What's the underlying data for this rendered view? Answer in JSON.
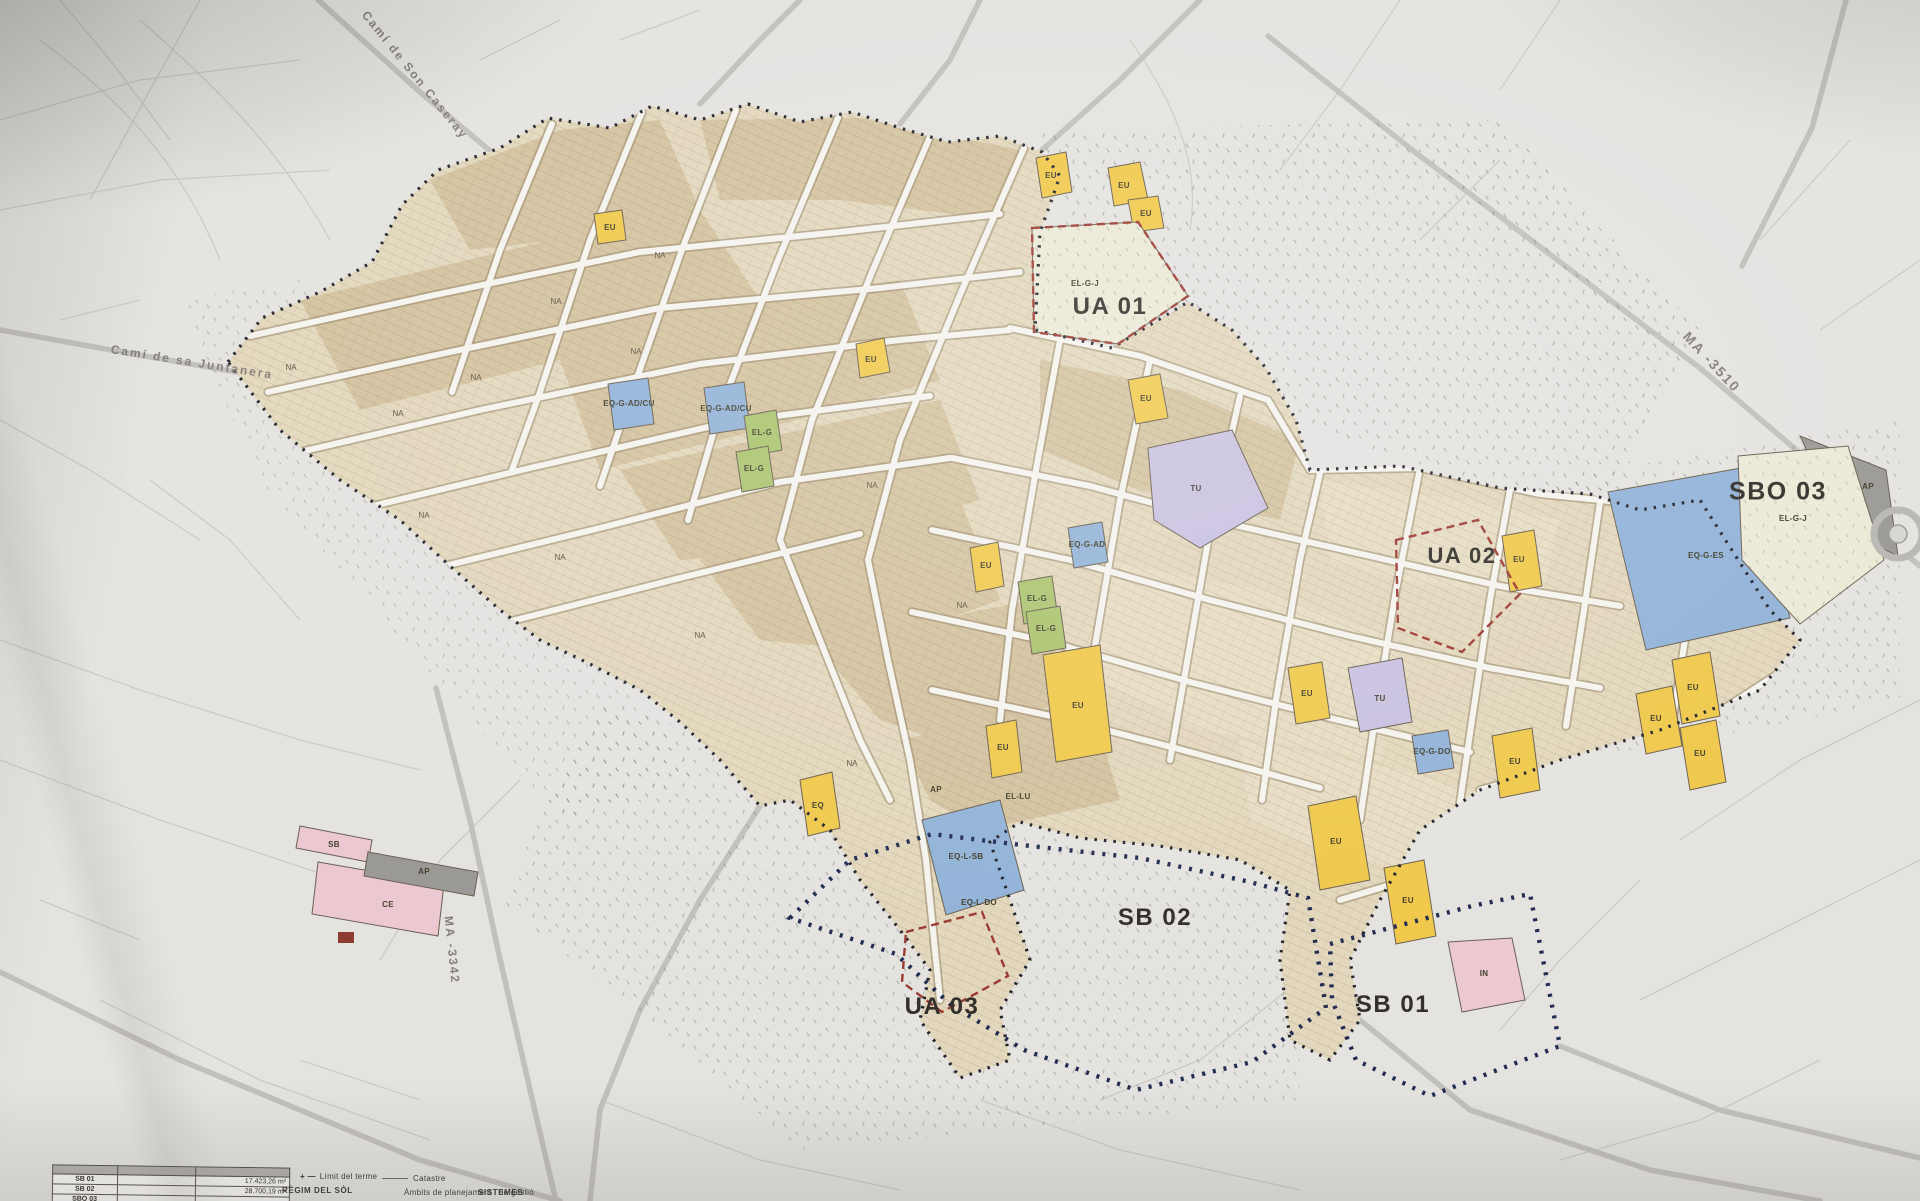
{
  "document_type": "Fotografia d'un plànol urbanístic de zonificació",
  "colors": {
    "paper": "#e4e3e0",
    "town_base": "#e3d8bd",
    "block_dark": "#cdb891",
    "street": "#f5f3ee",
    "yellow_eu": "#f0c94c",
    "blue_eq": "#92b3d8",
    "green_el": "#abc46f",
    "purple_tu": "#c9c1e0",
    "pink_zone": "#ecc8d0",
    "gray_ap": "#9b9995",
    "cream_elgj": "#ebe9d6",
    "red_dash": "#9c3b33",
    "navy_dots": "#232c52",
    "black_dots": "#23252e"
  },
  "map": {
    "labels": [
      {
        "id": "zone-label-ua-01",
        "cls": "zone",
        "text": "UA 01",
        "x": 1110,
        "y": 307,
        "fs": 24
      },
      {
        "id": "zone-label-ua-02",
        "cls": "zone",
        "text": "UA 02",
        "x": 1462,
        "y": 556,
        "fs": 22
      },
      {
        "id": "zone-label-ua-03",
        "cls": "zone",
        "text": "UA 03",
        "x": 942,
        "y": 1007,
        "fs": 24
      },
      {
        "id": "zone-label-sb-01",
        "cls": "zone",
        "text": "SB 01",
        "x": 1393,
        "y": 1005,
        "fs": 24
      },
      {
        "id": "zone-label-sb-02",
        "cls": "zone",
        "text": "SB 02",
        "x": 1155,
        "y": 918,
        "fs": 24
      },
      {
        "id": "zone-label-sbo-03",
        "cls": "zone",
        "text": "SBO 03",
        "x": 1778,
        "y": 492,
        "fs": 25
      },
      {
        "id": "road-label-cami-son-caseray",
        "cls": "road",
        "text": "Camí de Son Caseray",
        "x": 415,
        "y": 75,
        "rot": 51,
        "fs": 12
      },
      {
        "id": "road-label-cami-sa-juntanera",
        "cls": "road",
        "text": "Camí de sa Juntanera",
        "x": 192,
        "y": 362,
        "rot": 9,
        "fs": 12
      },
      {
        "id": "road-label-ma-3510",
        "cls": "road",
        "text": "MA -3510",
        "x": 1712,
        "y": 362,
        "rot": 47,
        "fs": 14
      },
      {
        "id": "road-label-ma-3342",
        "cls": "road",
        "text": "MA -3342",
        "x": 452,
        "y": 950,
        "rot": 84,
        "fs": 12
      },
      {
        "id": "parcel-label-eu",
        "cls": "parcel",
        "text": "EU",
        "x": 610,
        "y": 228
      },
      {
        "id": "parcel-label-eu",
        "cls": "parcel",
        "text": "EU",
        "x": 1051,
        "y": 176
      },
      {
        "id": "parcel-label-eu",
        "cls": "parcel",
        "text": "EU",
        "x": 1124,
        "y": 186
      },
      {
        "id": "parcel-label-eu",
        "cls": "parcel",
        "text": "EU",
        "x": 1146,
        "y": 214
      },
      {
        "id": "parcel-label-eu",
        "cls": "parcel",
        "text": "EU",
        "x": 871,
        "y": 360
      },
      {
        "id": "parcel-label-eu",
        "cls": "parcel",
        "text": "EU",
        "x": 1146,
        "y": 399
      },
      {
        "id": "parcel-label-eu",
        "cls": "parcel",
        "text": "EU",
        "x": 986,
        "y": 566
      },
      {
        "id": "parcel-label-eu",
        "cls": "parcel",
        "text": "EU",
        "x": 1003,
        "y": 748
      },
      {
        "id": "parcel-label-eq",
        "cls": "parcel",
        "text": "EQ",
        "x": 818,
        "y": 806
      },
      {
        "id": "parcel-label-eu",
        "cls": "parcel",
        "text": "EU",
        "x": 1307,
        "y": 694
      },
      {
        "id": "parcel-label-eu",
        "cls": "parcel",
        "text": "EU",
        "x": 1519,
        "y": 560
      },
      {
        "id": "parcel-label-eu",
        "cls": "parcel",
        "text": "EU",
        "x": 1693,
        "y": 688
      },
      {
        "id": "parcel-label-eu",
        "cls": "parcel",
        "text": "EU",
        "x": 1656,
        "y": 719
      },
      {
        "id": "parcel-label-eu",
        "cls": "parcel",
        "text": "EU",
        "x": 1700,
        "y": 754
      },
      {
        "id": "parcel-label-eu",
        "cls": "parcel",
        "text": "EU",
        "x": 1336,
        "y": 842
      },
      {
        "id": "parcel-label-eu",
        "cls": "parcel",
        "text": "EU",
        "x": 1408,
        "y": 901
      },
      {
        "id": "parcel-label-eu",
        "cls": "parcel",
        "text": "EU",
        "x": 1515,
        "y": 762
      },
      {
        "id": "parcel-label-eu",
        "cls": "parcel",
        "text": "EU",
        "x": 1078,
        "y": 706
      },
      {
        "id": "parcel-label-eq-g-adcu",
        "cls": "parcel",
        "text": "EQ-G-AD/CU",
        "x": 629,
        "y": 404
      },
      {
        "id": "parcel-label-eq-g-adcu",
        "cls": "parcel",
        "text": "EQ-G-AD/CU",
        "x": 726,
        "y": 409
      },
      {
        "id": "parcel-label-eq-g-ad",
        "cls": "parcel",
        "text": "EQ-G-AD",
        "x": 1087,
        "y": 545
      },
      {
        "id": "parcel-label-eq-g-es",
        "cls": "parcel",
        "text": "EQ-G-ES",
        "x": 1706,
        "y": 556
      },
      {
        "id": "parcel-label-eq-g-do",
        "cls": "parcel",
        "text": "EQ-G-DO",
        "x": 1432,
        "y": 752
      },
      {
        "id": "parcel-label-eq-l-sb",
        "cls": "parcel",
        "text": "EQ-L-SB",
        "x": 966,
        "y": 857
      },
      {
        "id": "parcel-label-eq-l-do",
        "cls": "parcel",
        "text": "EQ-L-DO",
        "x": 979,
        "y": 903
      },
      {
        "id": "parcel-label-el-lu",
        "cls": "parcel",
        "text": "EL-LU",
        "x": 1018,
        "y": 797
      },
      {
        "id": "parcel-label-ap",
        "cls": "parcel",
        "text": "AP",
        "x": 936,
        "y": 790
      },
      {
        "id": "parcel-label-el-g",
        "cls": "parcel",
        "text": "EL-G",
        "x": 762,
        "y": 433
      },
      {
        "id": "parcel-label-el-g",
        "cls": "parcel",
        "text": "EL-G",
        "x": 754,
        "y": 469
      },
      {
        "id": "parcel-label-el-g",
        "cls": "parcel",
        "text": "EL-G",
        "x": 1037,
        "y": 599
      },
      {
        "id": "parcel-label-el-g",
        "cls": "parcel",
        "text": "EL-G",
        "x": 1046,
        "y": 629
      },
      {
        "id": "parcel-label-tu",
        "cls": "parcel",
        "text": "TU",
        "x": 1196,
        "y": 489
      },
      {
        "id": "parcel-label-tu",
        "cls": "parcel",
        "text": "TU",
        "x": 1380,
        "y": 699
      },
      {
        "id": "parcel-label-el-g-j",
        "cls": "parcel",
        "text": "EL-G-J",
        "x": 1085,
        "y": 284
      },
      {
        "id": "parcel-label-el-g-j",
        "cls": "parcel",
        "text": "EL-G-J",
        "x": 1793,
        "y": 519
      },
      {
        "id": "parcel-label-ap",
        "cls": "parcel",
        "text": "AP",
        "x": 1868,
        "y": 487
      },
      {
        "id": "parcel-label-ap",
        "cls": "parcel",
        "text": "AP",
        "x": 424,
        "y": 872
      },
      {
        "id": "parcel-label-sb",
        "cls": "parcel",
        "text": "SB",
        "x": 334,
        "y": 845
      },
      {
        "id": "parcel-label-ce",
        "cls": "parcel",
        "text": "CE",
        "x": 388,
        "y": 905
      },
      {
        "id": "parcel-label-in",
        "cls": "parcel",
        "text": "IN",
        "x": 1484,
        "y": 974
      },
      {
        "id": "parcel-label-na",
        "cls": "na",
        "text": "NA",
        "x": 291,
        "y": 368
      },
      {
        "id": "parcel-label-na",
        "cls": "na",
        "text": "NA",
        "x": 398,
        "y": 414
      },
      {
        "id": "parcel-label-na",
        "cls": "na",
        "text": "NA",
        "x": 476,
        "y": 378
      },
      {
        "id": "parcel-label-na",
        "cls": "na",
        "text": "NA",
        "x": 556,
        "y": 302
      },
      {
        "id": "parcel-label-na",
        "cls": "na",
        "text": "NA",
        "x": 660,
        "y": 256
      },
      {
        "id": "parcel-label-na",
        "cls": "na",
        "text": "NA",
        "x": 424,
        "y": 516
      },
      {
        "id": "parcel-label-na",
        "cls": "na",
        "text": "NA",
        "x": 560,
        "y": 558
      },
      {
        "id": "parcel-label-na",
        "cls": "na",
        "text": "NA",
        "x": 700,
        "y": 636
      },
      {
        "id": "parcel-label-na",
        "cls": "na",
        "text": "NA",
        "x": 852,
        "y": 764
      },
      {
        "id": "parcel-label-na",
        "cls": "na",
        "text": "NA",
        "x": 636,
        "y": 352
      },
      {
        "id": "parcel-label-na",
        "cls": "na",
        "text": "NA",
        "x": 962,
        "y": 606
      },
      {
        "id": "parcel-label-na",
        "cls": "na",
        "text": "NA",
        "x": 872,
        "y": 486
      }
    ]
  },
  "legend": {
    "limit_symbol": "+ —",
    "limit_label": "Límit del terme",
    "catastre_label": "Catastre",
    "regim_label": "RÈGIM DEL SÒL",
    "ambits_label": "Àmbits de planejament i de gestió",
    "sistemes_label": "SISTEMES"
  },
  "area_table": {
    "rows": [
      {
        "code": "SB 01",
        "mid": "",
        "area": "17.423,26 m²"
      },
      {
        "code": "SB 02",
        "mid": "",
        "area": "28.700,19 m²"
      },
      {
        "code": "SBO 03",
        "mid": "",
        "area": ""
      }
    ]
  }
}
